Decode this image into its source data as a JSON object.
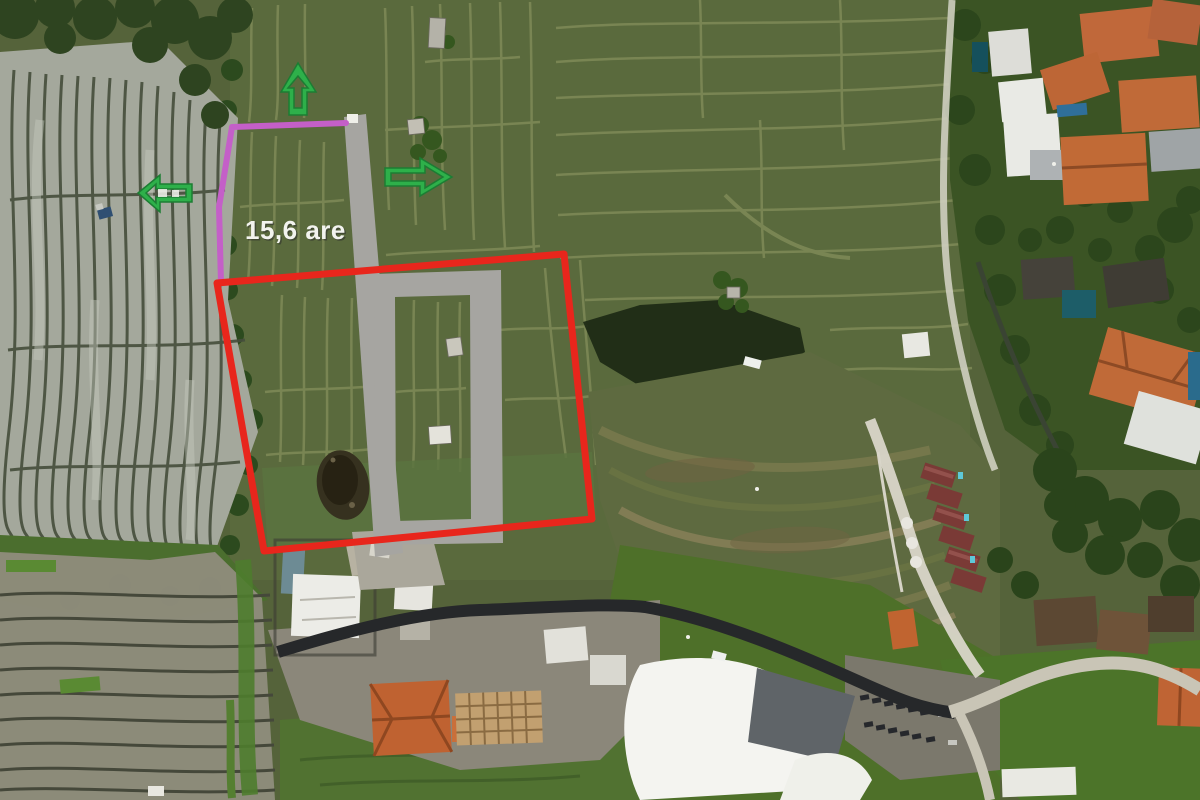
{
  "annotations": {
    "area_label": {
      "text": "15,6 are",
      "color": "#f2f3ee"
    },
    "plot_boundary": {
      "color": "#e8261c"
    },
    "secondary_boundary": {
      "color": "#c45fc8"
    },
    "road_overlay": {
      "color": "#a6a5a1"
    },
    "arrows": {
      "color": "#2eb04a",
      "directions": [
        "up",
        "right",
        "left"
      ]
    }
  }
}
